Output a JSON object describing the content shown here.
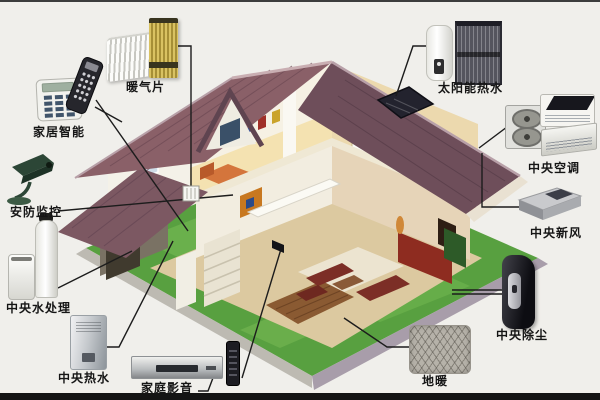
{
  "diagram": {
    "kind": "smart-home cutaway house system diagram",
    "background_color": "#f0efeb",
    "devices": [
      {
        "id": "radiator",
        "label": "暖气片"
      },
      {
        "id": "smart-home-control",
        "label": "家居智能"
      },
      {
        "id": "security-monitoring",
        "label": "安防监控"
      },
      {
        "id": "central-water-treatment",
        "label": "中央水处理"
      },
      {
        "id": "central-hot-water",
        "label": "中央热水"
      },
      {
        "id": "home-audio-video",
        "label": "家庭影音"
      },
      {
        "id": "floor-heating",
        "label": "地暖"
      },
      {
        "id": "central-vacuum",
        "label": "中央除尘"
      },
      {
        "id": "central-fresh-air",
        "label": "中央新风"
      },
      {
        "id": "central-air-conditioning",
        "label": "中央空调"
      },
      {
        "id": "solar-hot-water",
        "label": "太阳能热水"
      }
    ],
    "colors": {
      "roof": "#8a6068",
      "lawn": "#58a040",
      "radiator_yellow": "#c0a848",
      "leader_line": "#1c1c1c",
      "walkway": "#bdbab2"
    }
  }
}
